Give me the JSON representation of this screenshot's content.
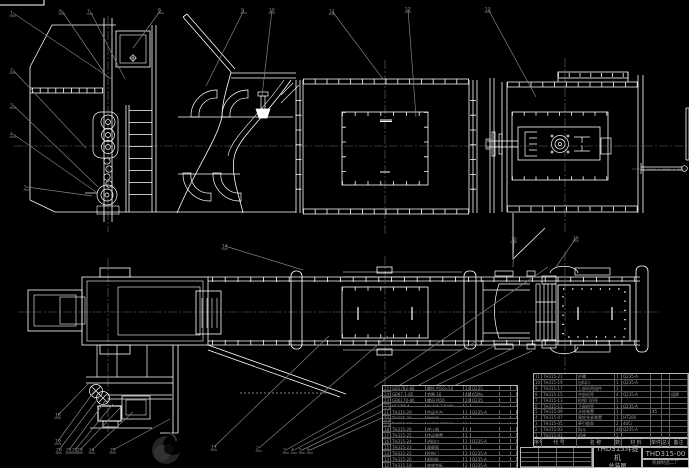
{
  "colors": {
    "background": "#000000",
    "line": "#ffffff",
    "leader": "#828282",
    "centerline": "#6a6a6a",
    "table_text": "#9c9c9c",
    "title_text": "#b9b9b9"
  },
  "title_block": {
    "product": "THD315斗提机",
    "drawing_title": "总装图",
    "drawing_no": "THD315-00",
    "company": "机械制造二厂"
  },
  "bom": {
    "header_rows": [
      [
        "序号",
        "代 号",
        "名 称",
        "数量",
        "材 料",
        "单件",
        "总计",
        "备注"
      ]
    ],
    "right_rows": [
      [
        "11",
        "TH315-21",
        "护罩",
        "1",
        "Q235-A",
        "",
        "",
        ""
      ],
      [
        "10",
        "TH315-19",
        "出料口",
        "1",
        "Q235-A",
        "",
        "",
        ""
      ],
      [
        "9",
        "TH315-17",
        "上部机壳组件",
        "1",
        "",
        "",
        "",
        ""
      ],
      [
        "8",
        "TH315-15",
        "中部机壳",
        "4",
        "Q235-A",
        "",
        "",
        "组焊"
      ],
      [
        "7",
        "TH315-13",
        "检视门机壳",
        "1",
        "",
        "",
        "",
        ""
      ],
      [
        "6",
        "TH315-11",
        "下部机壳",
        "1",
        "Q235-A",
        "",
        "",
        ""
      ],
      [
        "5",
        "TH315-09",
        "头轮装置",
        "1",
        "",
        "45",
        "",
        ""
      ],
      [
        "4",
        "TH315-07",
        "尾轮张紧装置",
        "1",
        "HT200",
        "",
        "",
        ""
      ],
      [
        "3",
        "TH315-05",
        "牵引链条",
        "2",
        "40Cr",
        "",
        "",
        ""
      ],
      [
        "2",
        "TH315-03",
        "料斗",
        "46",
        "Q235-A",
        "",
        "",
        ""
      ],
      [
        "1",
        "TH315-01",
        "机座",
        "1",
        "",
        "",
        "",
        ""
      ]
    ],
    "left_rows": [
      [
        "25",
        "GB5782-86",
        "螺栓 M16×50",
        "24",
        "Q235",
        "",
        "",
        ""
      ],
      [
        "24",
        "GB97.1-85",
        "垫圈 16",
        "48",
        "65Mn",
        "",
        "",
        ""
      ],
      [
        "23",
        "GB6170-86",
        "螺母 M16",
        "24",
        "Q235",
        "",
        "",
        ""
      ],
      [
        "22",
        "Y132M-4",
        "电动机 7.5kW",
        "1",
        "",
        "",
        "",
        "外购"
      ],
      [
        "21",
        "TH315-29",
        "传动平台",
        "1",
        "Q235-A",
        "",
        "",
        ""
      ],
      [
        "20",
        "TH315-28",
        "联轴器",
        "1",
        "",
        "",
        "",
        "外购"
      ],
      [
        "19",
        "TH315-27",
        "减速器 ZQ350",
        "1",
        "",
        "",
        "",
        "外购"
      ],
      [
        "18",
        "TH315-26",
        "逆止器",
        "1",
        "",
        "",
        "",
        ""
      ],
      [
        "17",
        "TH315-25",
        "传动装置",
        "1",
        "",
        "",
        "",
        ""
      ],
      [
        "16",
        "TH315-24",
        "进料口",
        "1",
        "Q235-A",
        "",
        "",
        ""
      ],
      [
        "15",
        "TH315-23",
        "观察窗",
        "1",
        "",
        "",
        "",
        ""
      ],
      [
        "14",
        "TH315-22",
        "检修门",
        "2",
        "Q235-A",
        "",
        "",
        ""
      ],
      [
        "13",
        "TH315-20",
        "卸料板",
        "1",
        "Q235-A",
        "",
        "",
        ""
      ],
      [
        "12",
        "TH315-18",
        "底座垫板",
        "2",
        "Q235-A",
        "",
        "",
        ""
      ]
    ]
  },
  "balloons": [
    {
      "n": "1",
      "x": 10,
      "y": 11,
      "tx": 113,
      "ty": 80
    },
    {
      "n": "2",
      "x": 10,
      "y": 68,
      "tx": 86,
      "ty": 148
    },
    {
      "n": "3",
      "x": 10,
      "y": 103,
      "tx": 98,
      "ty": 187
    },
    {
      "n": "4",
      "x": 10,
      "y": 132,
      "tx": 96,
      "ty": 192
    },
    {
      "n": "5",
      "x": 24,
      "y": 185,
      "tx": 92,
      "ty": 196
    },
    {
      "n": "6",
      "x": 59,
      "y": 9,
      "tx": 107,
      "ty": 77
    },
    {
      "n": "7",
      "x": 87,
      "y": 9,
      "tx": 125,
      "ty": 79
    },
    {
      "n": "8",
      "x": 158,
      "y": 8,
      "tx": 133,
      "ty": 48
    },
    {
      "n": "9",
      "x": 241,
      "y": 8,
      "tx": 206,
      "ty": 86
    },
    {
      "n": "10",
      "x": 269,
      "y": 8,
      "tx": 262,
      "ty": 96
    },
    {
      "n": "11",
      "x": 329,
      "y": 9,
      "tx": 383,
      "ty": 79
    },
    {
      "n": "12",
      "x": 405,
      "y": 7,
      "tx": 416,
      "ty": 117
    },
    {
      "n": "13",
      "x": 485,
      "y": 7,
      "tx": 536,
      "ty": 97
    },
    {
      "n": "14",
      "x": 222,
      "y": 244,
      "tx": 303,
      "ty": 270
    },
    {
      "n": "15",
      "x": 511,
      "y": 237,
      "tx": 513,
      "ty": 267
    },
    {
      "n": "16",
      "x": 573,
      "y": 236,
      "tx": 556,
      "ty": 267
    },
    {
      "n": "17",
      "x": 211,
      "y": 445,
      "tx": 329,
      "ty": 336
    },
    {
      "n": "18",
      "x": 55,
      "y": 413,
      "tx": 90,
      "ty": 382
    },
    {
      "n": "19",
      "x": 55,
      "y": 439,
      "tx": 95,
      "ty": 390
    },
    {
      "n": "20",
      "x": 56,
      "y": 448,
      "tx": 100,
      "ty": 396
    },
    {
      "n": "21",
      "x": 66,
      "y": 448,
      "tx": 106,
      "ty": 400
    },
    {
      "n": "22",
      "x": 72,
      "y": 448,
      "tx": 113,
      "ty": 404
    },
    {
      "n": "23",
      "x": 77,
      "y": 448,
      "tx": 120,
      "ty": 408
    },
    {
      "n": "24",
      "x": 89,
      "y": 448,
      "tx": 133,
      "ty": 412
    },
    {
      "n": "25",
      "x": 110,
      "y": 448,
      "tx": 170,
      "ty": 419
    },
    {
      "n": "2",
      "x": 256,
      "y": 446,
      "tx": 388,
      "ty": 336
    },
    {
      "n": "3",
      "x": 283,
      "y": 448,
      "tx": 477,
      "ty": 341
    },
    {
      "n": "4",
      "x": 291,
      "y": 448,
      "tx": 496,
      "ty": 345
    },
    {
      "n": "5",
      "x": 299,
      "y": 448,
      "tx": 514,
      "ty": 348
    },
    {
      "n": "6",
      "x": 307,
      "y": 448,
      "tx": 532,
      "ty": 351
    }
  ],
  "extra_leaders": [
    {
      "x1": 548,
      "y1": 267,
      "x2": 374,
      "y2": 387
    }
  ]
}
